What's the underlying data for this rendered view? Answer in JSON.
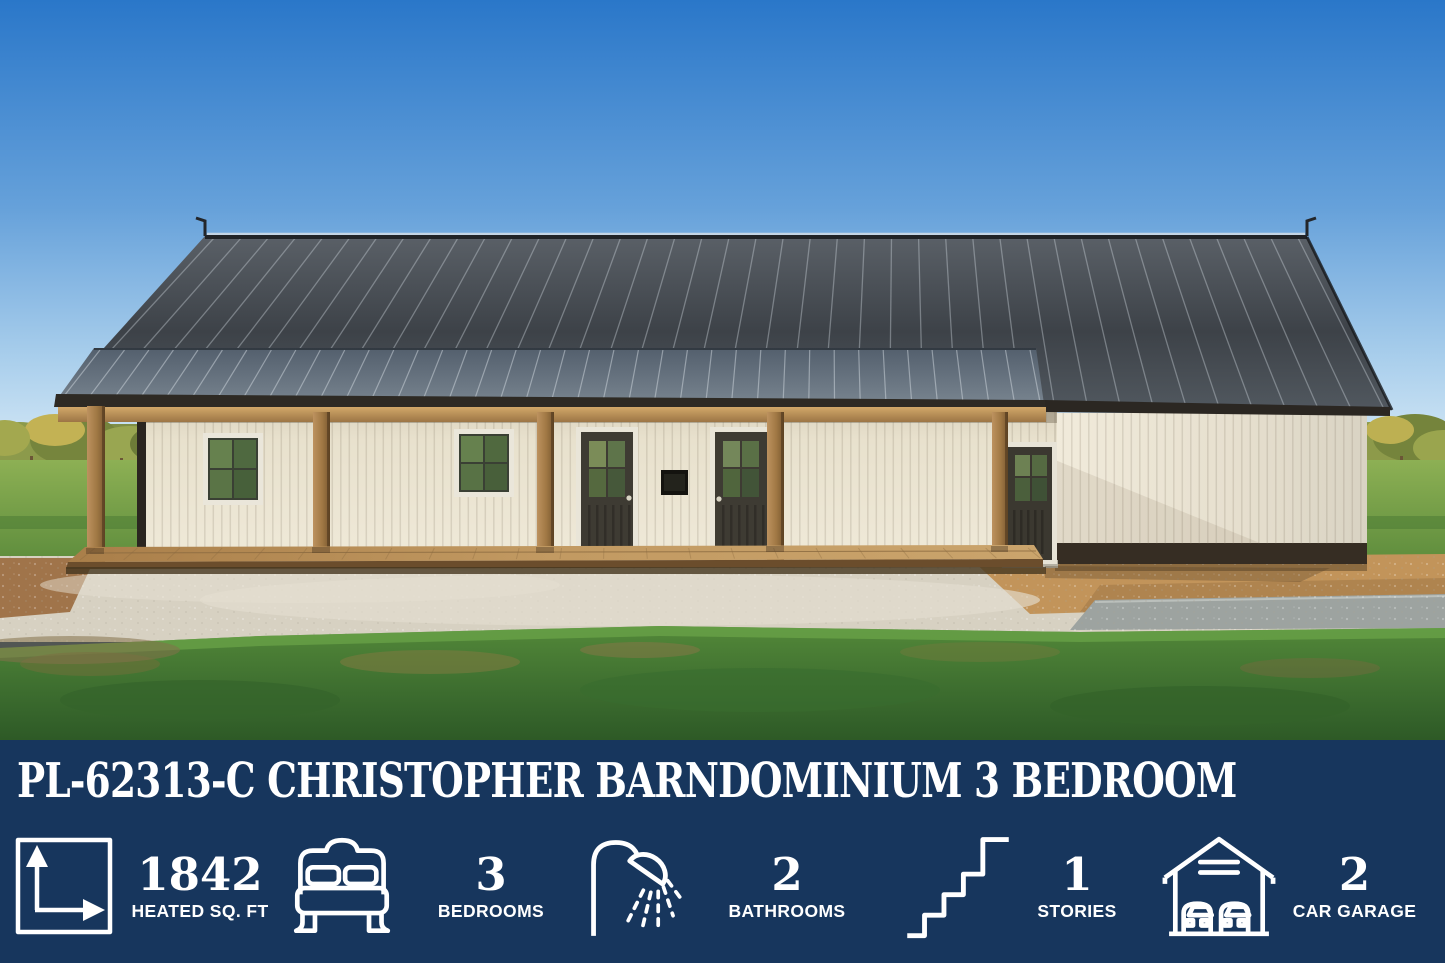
{
  "banner": {
    "background_color": "#17365D",
    "text_color": "#FFFFFF",
    "title": "PL-62313-C CHRISTOPHER BARNDOMINIUM 3 BEDROOM",
    "stats": [
      {
        "icon": "area-dimensions-icon",
        "value": "1842",
        "label": "HEATED SQ. FT"
      },
      {
        "icon": "bed-icon",
        "value": "3",
        "label": "BEDROOMS"
      },
      {
        "icon": "shower-icon",
        "value": "2",
        "label": "BATHROOMS"
      },
      {
        "icon": "stairs-icon",
        "value": "1",
        "label": "STORIES"
      },
      {
        "icon": "garage-icon",
        "value": "2",
        "label": "CAR GARAGE"
      }
    ]
  }
}
